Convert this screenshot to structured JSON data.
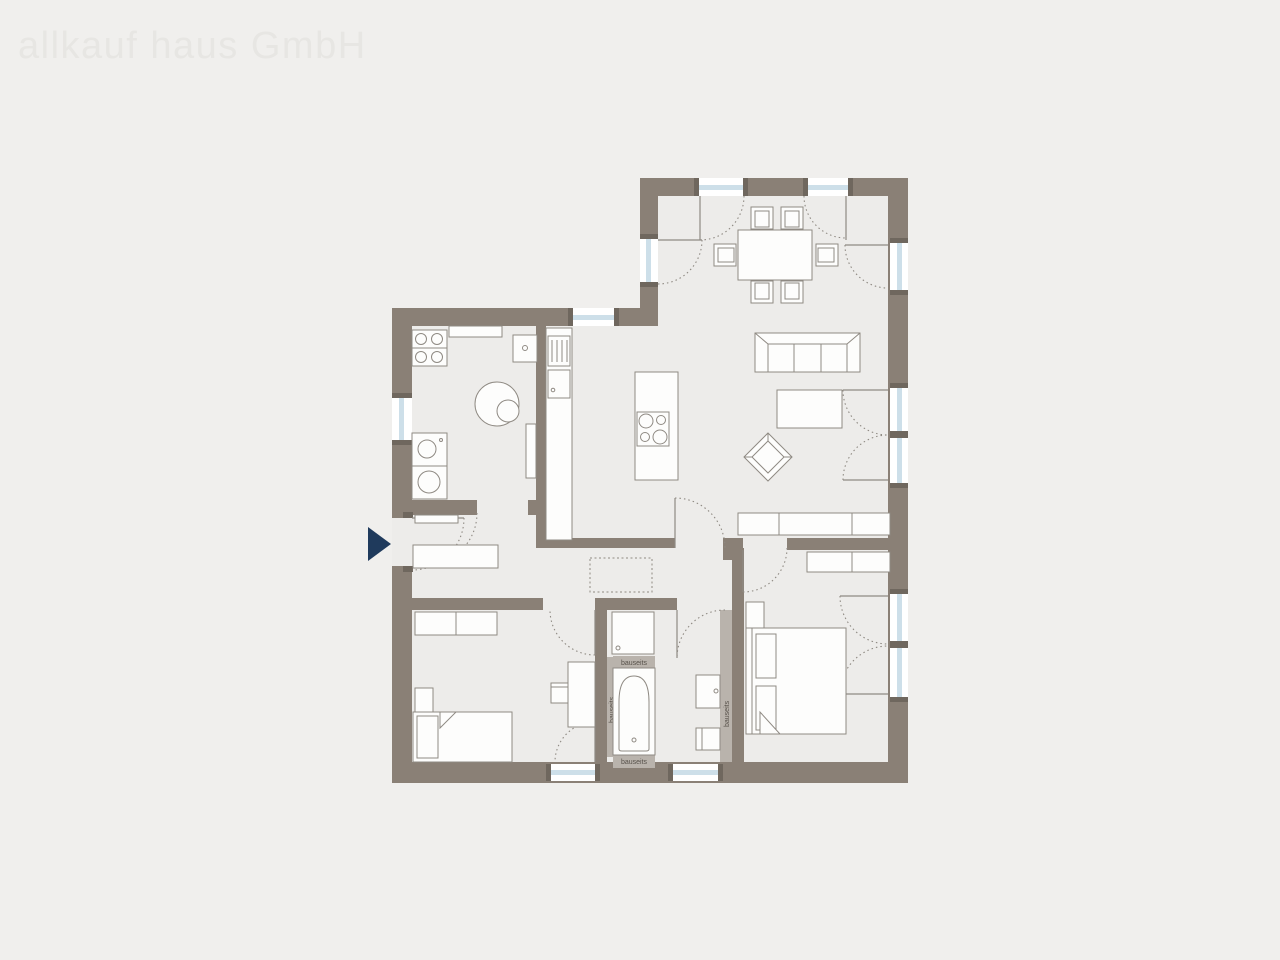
{
  "watermark": "allkauf haus GmbH",
  "plan": {
    "labels": {
      "tub_top": "bauseits",
      "tub_bottom": "bauseits",
      "tub_side": "bauseits",
      "wc_side": "bauseits"
    },
    "colors": {
      "background": "#f0efed",
      "floor": "#edecea",
      "wall": "#8a8076",
      "onsite_wall": "#b9b3ac",
      "glazing": "#cddfe9",
      "window_cap": "#6f675e",
      "furniture_outline": "#8f8a83",
      "entrance_arrow": "#1f3a5c",
      "watermark_text": "#e7e6e3",
      "label_text": "#57514a"
    }
  }
}
